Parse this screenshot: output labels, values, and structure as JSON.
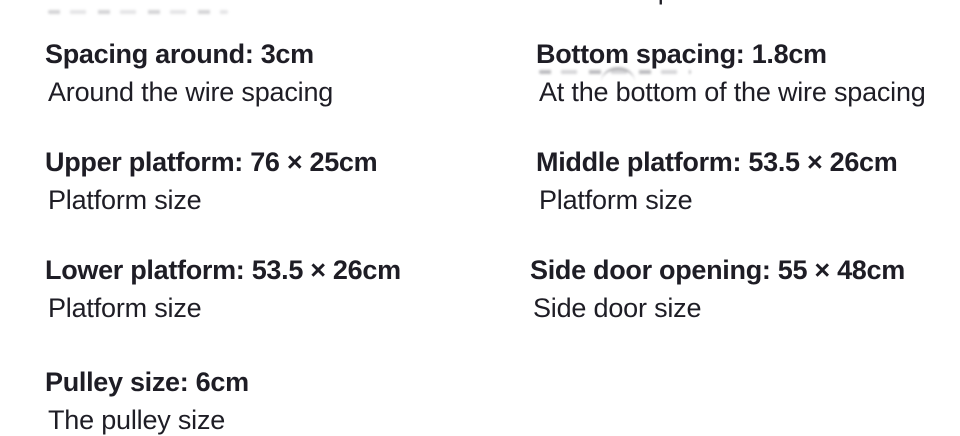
{
  "page": {
    "background": "#ffffff",
    "text_color": "#1e1d25",
    "smudge_color": "#6e6e76"
  },
  "specs": {
    "left": [
      {
        "heading": "",
        "description": "Front door size",
        "note": "clipped at top edge"
      },
      {
        "heading": "Spacing around: 3cm",
        "description": "Around the wire spacing"
      },
      {
        "heading": "Upper platform: 76 × 25cm",
        "description": "Platform size"
      },
      {
        "heading": "Lower platform: 53.5 × 26cm",
        "description": "Platform size"
      },
      {
        "heading": "Pulley size: 6cm",
        "description": "The pulley size"
      }
    ],
    "right": [
      {
        "heading": "",
        "description": "At the top of the window size",
        "note": "clipped at top edge"
      },
      {
        "heading": "Bottom spacing: 1.8cm",
        "description": "At the bottom of the wire spacing"
      },
      {
        "heading": "Middle platform: 53.5 × 26cm",
        "description": "Platform size"
      },
      {
        "heading": "Side door opening: 55 × 48cm",
        "description": "Side door size"
      }
    ]
  }
}
